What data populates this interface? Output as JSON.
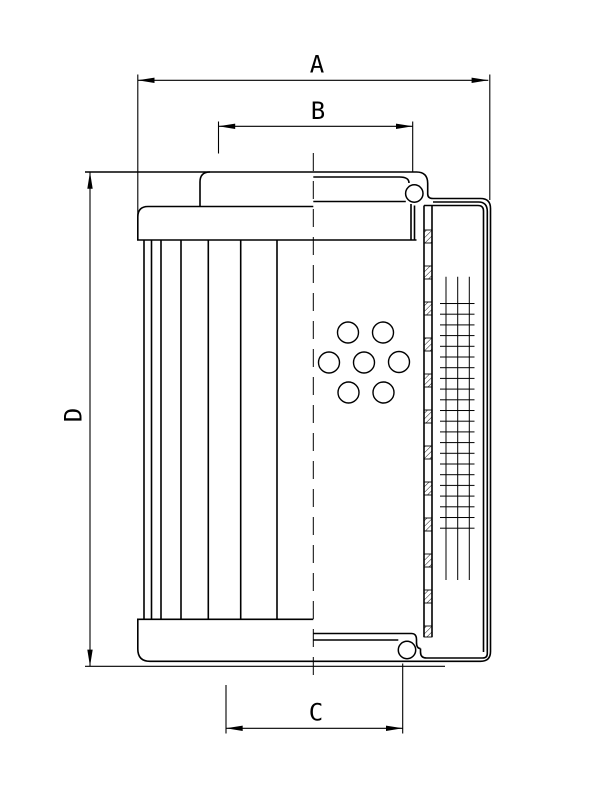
{
  "page": {
    "background_color": "#ffffff"
  },
  "drawing": {
    "type": "technical-drawing-filter-element",
    "line_color": "#000000",
    "background_color": "#ffffff",
    "dimension_labels": {
      "a": "A",
      "b": "B",
      "c": "C",
      "d": "D"
    },
    "features": {
      "perforation_hole_count": 7,
      "pleat_line_count": 7,
      "support_tube_hatch_segment_count": 12
    }
  }
}
